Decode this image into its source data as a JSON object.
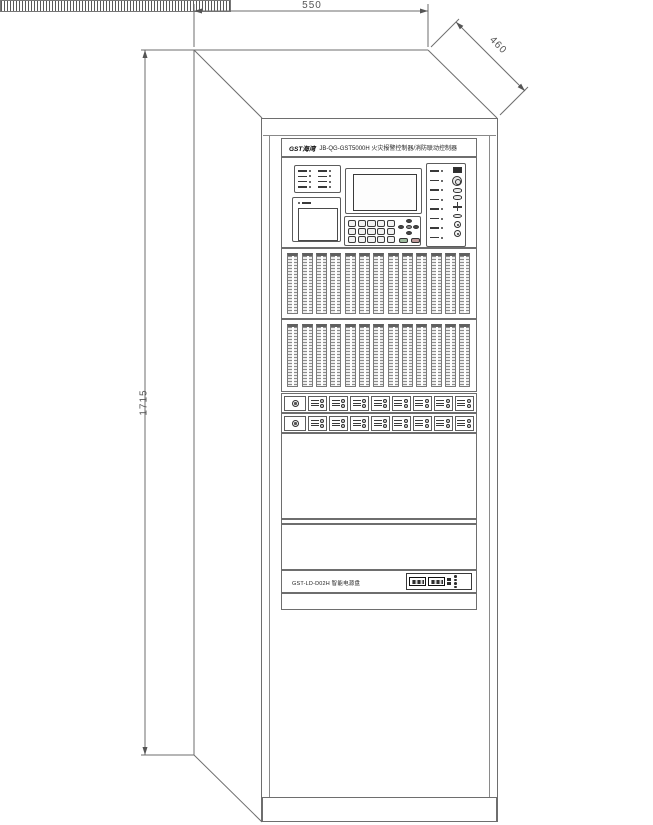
{
  "dimension_labels": {
    "width": "550",
    "depth": "460",
    "height": "1715"
  },
  "cabinet": {
    "header": {
      "logo_text": "GST海湾",
      "model_title": "JB-QG-GST5000H 火灾报警控制器/消防联动控制器"
    },
    "power_panel": {
      "label": "GST-LD-D02H 智能电源盘"
    },
    "counts": {
      "loop_rows": 2,
      "loop_cards_per_row": 13,
      "module_rows": 2,
      "modules_per_row": 8,
      "left_indicator_count": 8,
      "right_indicator_count": 8,
      "keypad_keys": 15
    }
  },
  "colors": {
    "line": "#6e6e6e",
    "detail": "#3a3a3a",
    "background": "#ffffff"
  }
}
